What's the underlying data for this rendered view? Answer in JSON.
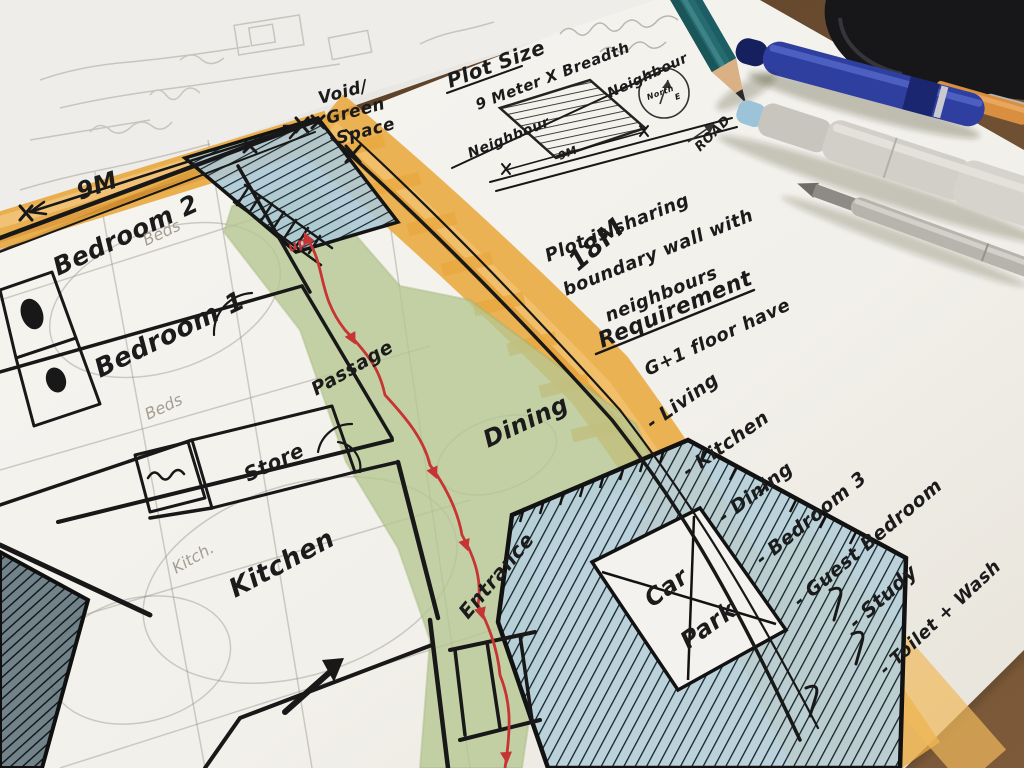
{
  "plan": {
    "dim_9m": "9M",
    "dim_18m": "18M",
    "void_lines": [
      "Void/",
      "Green",
      "Space"
    ],
    "bedroom2": "Bedroom 2",
    "bedroom1": "Bedroom 1",
    "store": "Store",
    "kitchen": "Kitchen",
    "dining": "Dining",
    "passage": "Passage",
    "entrance": "Entrance",
    "carpark_line1": "Car",
    "carpark_line2": "Park",
    "up": "up",
    "pencil": {
      "beds": "Beds",
      "kitch": "Kitch."
    }
  },
  "notes": {
    "plot_size_title": "Plot Size",
    "plot_size_value": "9 Meter X Breadth",
    "neighbour_left": "Neighbour",
    "neighbour_right": "Neighbour",
    "north": "North",
    "east": "E",
    "road": "ROAD",
    "plot_width": "9M",
    "sharing_lines": [
      "Plot is sharing",
      "boundary wall with",
      "neighbours"
    ],
    "requirement_title": "Requirement",
    "requirement_sub": "G+1 floor have",
    "items": [
      "- Living",
      "- Kitchen",
      "- Dining",
      "- Bedroom 3",
      "- Guest Bedroom",
      "- Study",
      "- Toilet + Wash"
    ]
  },
  "colors": {
    "paper": "#f4f2ee",
    "tracing_paper": "#e9e7e3",
    "desk": "#6e4e31",
    "marker_orange": "#e9a93f",
    "plan_green": "#b6c791",
    "hatch_blue": "#aec9d6",
    "path_red": "#c63434",
    "ink": "#1b1b1b",
    "pencil_gray": "#9a948a"
  }
}
